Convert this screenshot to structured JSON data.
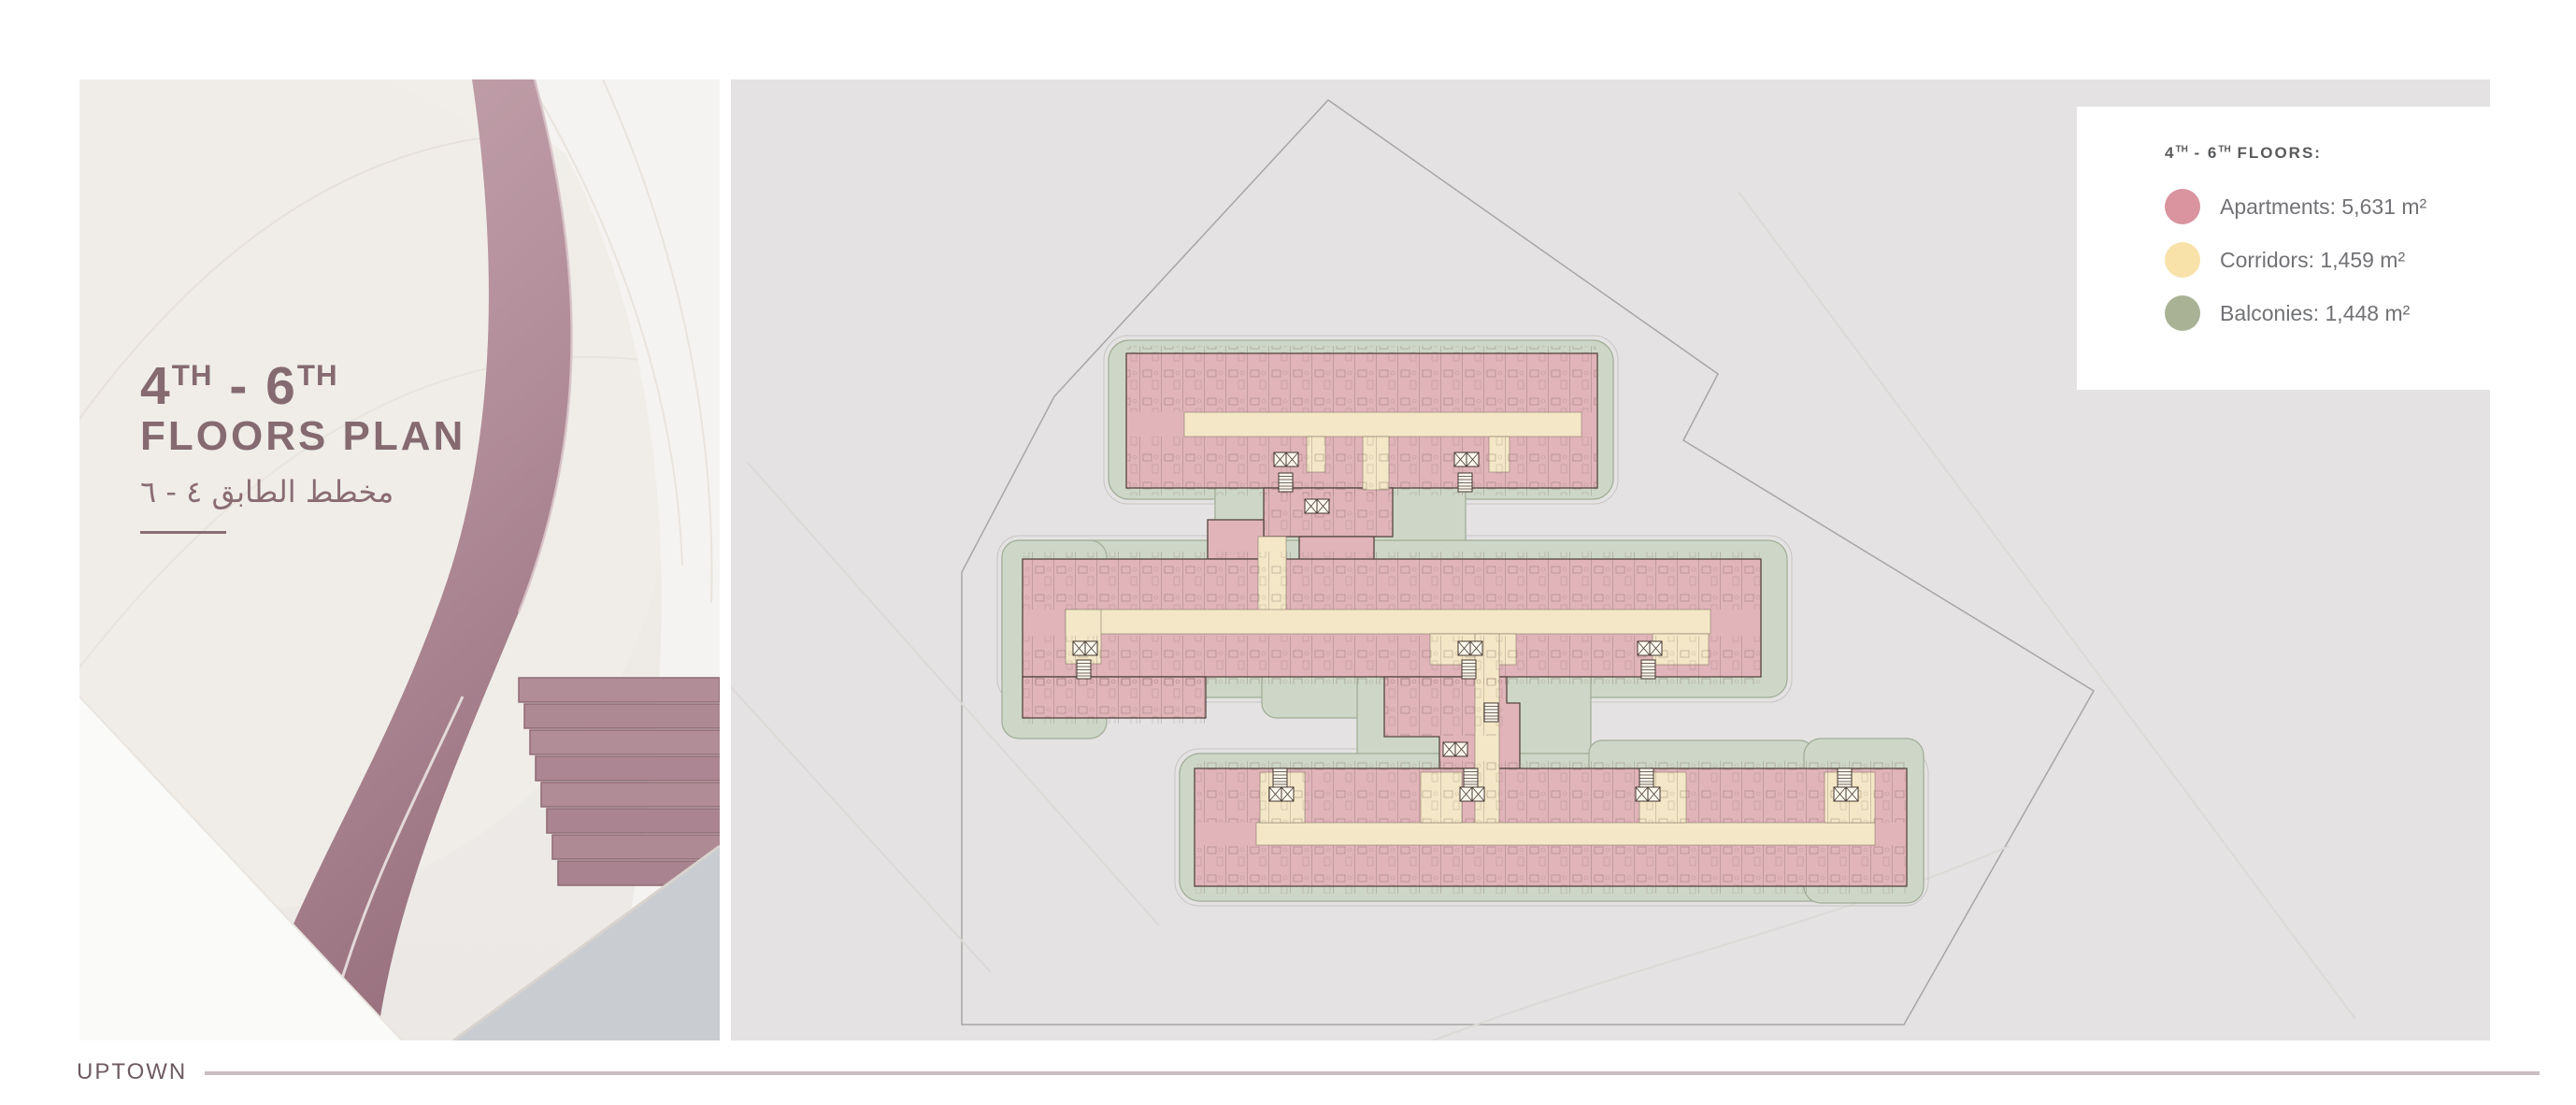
{
  "title_block": {
    "line1": {
      "n1": "4",
      "s1": "TH",
      "dash": " - ",
      "n2": "6",
      "s2": "TH"
    },
    "line2": "FLOORS PLAN",
    "arabic": "مخطط الطابق ٤ - ٦"
  },
  "legend": {
    "header": {
      "n1": "4",
      "s1": "TH",
      "dash": " - ",
      "n2": "6",
      "s2": "TH",
      "rest": " FLOORS:"
    },
    "items": [
      {
        "name": "apartments",
        "label": "Apartments: 5,631 m²",
        "color": "#d9949f"
      },
      {
        "name": "corridors",
        "label": "Corridors: 1,459 m²",
        "color": "#f8e2aa"
      },
      {
        "name": "balconies",
        "label": "Balconies: 1,448 m²",
        "color": "#a9b295"
      }
    ]
  },
  "plan": {
    "colors": {
      "apartments_fill": "#e0b4b9",
      "corridors_fill": "#f3e7c7",
      "balconies_fill": "#ced7c7",
      "site_outline": "#a8a6a4",
      "panel_background": "#e4e2e3"
    }
  },
  "footer": {
    "brand": "UPTOWN"
  }
}
